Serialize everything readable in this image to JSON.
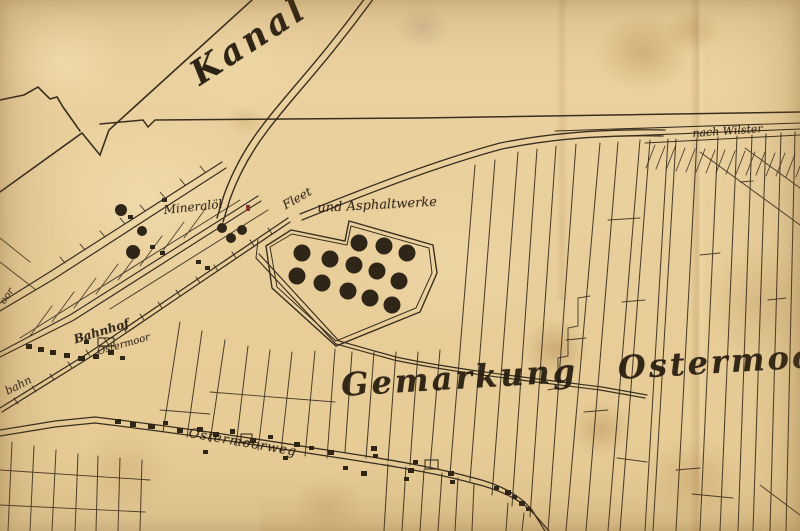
{
  "map": {
    "title_context": "Historic plan of Gemarkung Ostermoor with Kanal, Bahnhof and Asphaltwerke",
    "labels": {
      "kanal": "Kanal",
      "nach_wilster": "nach Wilster",
      "mineraloel": "Mineralöl",
      "fleet": "Fleet",
      "asphaltwerke": "und Asphaltwerke",
      "bahnhof": "Bahnhof",
      "bahnhof_sub": "Ostermoor",
      "bahn": "bahn",
      "moor_partial": "oor",
      "gemarkung": "Gemarkung Ostermoor",
      "ostermoorweg": "Ostermoorweg"
    },
    "colors": {
      "paper": "#e9cf9c",
      "paper_light": "#f4e3b6",
      "paper_shadow": "#d8b57c",
      "ink_lines": "#2b2214",
      "ink_text": "#241b0e",
      "stain_brown": "#a97c3f",
      "accent_red": "#7d2a1c"
    },
    "symbols": {
      "tank_radius_large": 8.5,
      "tanks_large": [
        [
          302,
          253
        ],
        [
          330,
          259
        ],
        [
          354,
          265
        ],
        [
          377,
          271
        ],
        [
          359,
          243
        ],
        [
          384,
          246
        ],
        [
          407,
          253
        ],
        [
          297,
          276
        ],
        [
          322,
          283
        ],
        [
          348,
          291
        ],
        [
          370,
          298
        ],
        [
          399,
          281
        ],
        [
          392,
          305
        ]
      ],
      "tanks_small": [
        [
          133,
          252,
          7
        ],
        [
          142,
          231,
          5
        ],
        [
          121,
          210,
          6
        ],
        [
          222,
          228,
          5
        ],
        [
          231,
          238,
          5
        ],
        [
          242,
          230,
          5
        ]
      ],
      "buildings": [
        [
          26,
          344,
          6,
          5
        ],
        [
          38,
          347,
          6,
          5
        ],
        [
          50,
          350,
          6,
          5
        ],
        [
          64,
          353,
          6,
          5
        ],
        [
          78,
          356,
          7,
          5
        ],
        [
          93,
          354,
          6,
          5
        ],
        [
          108,
          350,
          6,
          5
        ],
        [
          120,
          356,
          5,
          4
        ],
        [
          84,
          340,
          5,
          4
        ],
        [
          128,
          215,
          5,
          4
        ],
        [
          162,
          198,
          5,
          4
        ],
        [
          150,
          245,
          5,
          4
        ],
        [
          160,
          251,
          5,
          4
        ],
        [
          196,
          260,
          5,
          4
        ],
        [
          205,
          266,
          5,
          4
        ],
        [
          115,
          419,
          6,
          5
        ],
        [
          130,
          422,
          6,
          5
        ],
        [
          148,
          424,
          7,
          5
        ],
        [
          163,
          421,
          5,
          4
        ],
        [
          177,
          428,
          6,
          5
        ],
        [
          197,
          427,
          6,
          5
        ],
        [
          213,
          432,
          6,
          5
        ],
        [
          230,
          429,
          5,
          5
        ],
        [
          250,
          438,
          6,
          5
        ],
        [
          268,
          435,
          5,
          4
        ],
        [
          294,
          442,
          6,
          5
        ],
        [
          309,
          446,
          5,
          4
        ],
        [
          328,
          450,
          6,
          5
        ],
        [
          371,
          446,
          6,
          5
        ],
        [
          373,
          454,
          5,
          4
        ],
        [
          361,
          471,
          6,
          5
        ],
        [
          408,
          468,
          6,
          5
        ],
        [
          413,
          460,
          5,
          4
        ],
        [
          448,
          471,
          6,
          5
        ],
        [
          450,
          480,
          5,
          4
        ],
        [
          494,
          486,
          5,
          4
        ],
        [
          505,
          490,
          6,
          5
        ],
        [
          512,
          495,
          5,
          4
        ],
        [
          519,
          501,
          6,
          5
        ],
        [
          526,
          507,
          5,
          4
        ],
        [
          203,
          450,
          5,
          4
        ],
        [
          283,
          456,
          5,
          4
        ],
        [
          343,
          466,
          5,
          4
        ],
        [
          404,
          477,
          5,
          4
        ]
      ],
      "building_outlines": [
        [
          98,
          338,
          16,
          8
        ],
        [
          425,
          460,
          13,
          9
        ],
        [
          241,
          434,
          11,
          8
        ]
      ],
      "red_mark": [
        246,
        205,
        4,
        6
      ]
    }
  }
}
